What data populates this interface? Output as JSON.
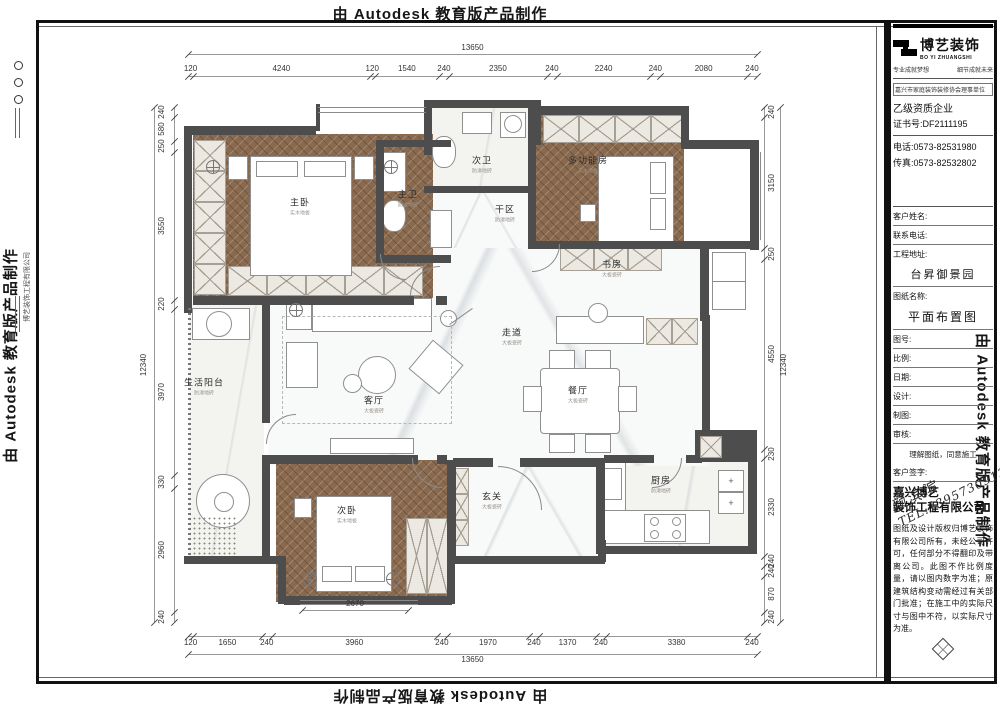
{
  "watermark": "由 Autodesk 教育版产品制作",
  "title_block": {
    "brand": {
      "cn": "博艺装饰",
      "en": "BO YI ZHUANGSHI"
    },
    "slogan_left": "专业成就梦想",
    "slogan_right": "细节成就未来",
    "association": "嘉兴市家庭装饰装修协会理事单位",
    "qualification": "乙级资质企业",
    "certificate": "证书号:DF2111195",
    "phone": "电话:0573-82531980",
    "fax": "传真:0573-82532802",
    "labels": {
      "customer": "客户姓名:",
      "contact": "联系电话:",
      "address": "工程地址:",
      "drawing": "图纸名称:",
      "number": "图号:",
      "scale": "比例:",
      "date": "日期:",
      "design": "设计:",
      "draft": "制图:",
      "review": "审核:",
      "sign": "客户签字:"
    },
    "address_value": "台昇御景园",
    "drawing_value": "平面布置图",
    "signature": {
      "name": "颜滨滨",
      "tel": "TEL:13957309133"
    },
    "agreement": "理解图纸，同意施工",
    "company_line1": "嘉兴博艺",
    "company_line2": "装饰工程有限公司",
    "company_vertical": "博艺装饰工程有限公司",
    "disclaimer": "图纸及设计版权归博艺装饰有限公司所有，未经公司许可，任何部分不得翻印及带离公司。此图不作比例度量，请以图内数字为准；原建筑结构变动需经过有关部门批准；在施工中的实际尺寸与图中不符，以实际尺寸为准。"
  },
  "rooms": [
    {
      "id": "master-bedroom",
      "name": "主卧",
      "note": "实木地板"
    },
    {
      "id": "master-bath",
      "name": "主卫",
      "note": "防滑地砖"
    },
    {
      "id": "second-bath",
      "name": "次卫",
      "note": "防滑地砖"
    },
    {
      "id": "dry-area",
      "name": "干区",
      "note": "防滑地砖"
    },
    {
      "id": "multi-room",
      "name": "多功能房",
      "note": "实木地板"
    },
    {
      "id": "study",
      "name": "书房",
      "note": "大板瓷砖"
    },
    {
      "id": "corridor",
      "name": "走道",
      "note": "大板瓷砖"
    },
    {
      "id": "living-room",
      "name": "客厅",
      "note": "大板瓷砖"
    },
    {
      "id": "dining-room",
      "name": "餐厅",
      "note": "大板瓷砖"
    },
    {
      "id": "kitchen",
      "name": "厨房",
      "note": "防滑地砖"
    },
    {
      "id": "entry",
      "name": "玄关",
      "note": "大板瓷砖"
    },
    {
      "id": "second-bedroom",
      "name": "次卧",
      "note": "实木地板"
    },
    {
      "id": "balcony",
      "name": "生活阳台",
      "note": "防滑地砖"
    }
  ],
  "dimensions": {
    "top": {
      "total": 13650,
      "segments": [
        120,
        4240,
        120,
        1540,
        240,
        2350,
        240,
        2240,
        240,
        2080,
        240
      ]
    },
    "bottom": {
      "total": 13650,
      "segments": [
        120,
        1650,
        240,
        3960,
        240,
        1970,
        240,
        1370,
        240,
        3380,
        240
      ],
      "extra": 2670
    },
    "left": {
      "total": 12340,
      "segments": [
        240,
        580,
        250,
        3550,
        220,
        3970,
        330,
        2960,
        240
      ]
    },
    "right": {
      "total": 12340,
      "segments": [
        240,
        3150,
        250,
        4550,
        230,
        2330,
        240,
        240,
        870,
        240
      ]
    }
  },
  "colors": {
    "wall": "#4d4d4d",
    "wood": "#8a6a4f",
    "ink": "#161616"
  }
}
